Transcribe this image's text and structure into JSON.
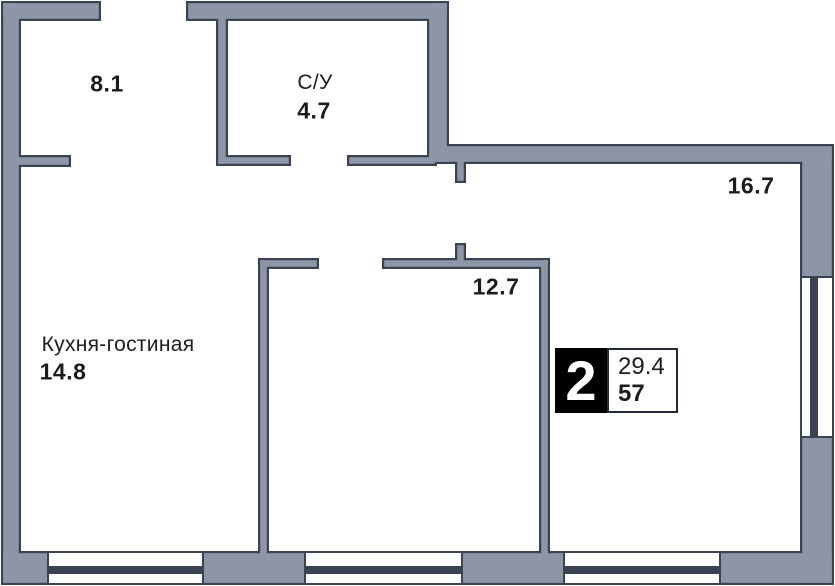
{
  "plan": {
    "rooms": [
      {
        "id": "hall",
        "area": "8.1"
      },
      {
        "id": "bathroom",
        "name": "С/У",
        "area": "4.7"
      },
      {
        "id": "room-1",
        "area": "16.7"
      },
      {
        "id": "room-2",
        "area": "12.7"
      },
      {
        "id": "kitchen-living",
        "name": "Кухня-гостиная",
        "area": "14.8"
      }
    ],
    "badge": {
      "rooms_count": "2",
      "living_area": "29.4",
      "total_area": "57"
    }
  },
  "colors": {
    "wall_fill": "#8e95a6",
    "outline": "#3a4254",
    "window_glass": "#3a4254",
    "badge_bg": "#000000",
    "badge_border": "#242a38",
    "text": "#1c1c1e",
    "background": "#ffffff"
  }
}
